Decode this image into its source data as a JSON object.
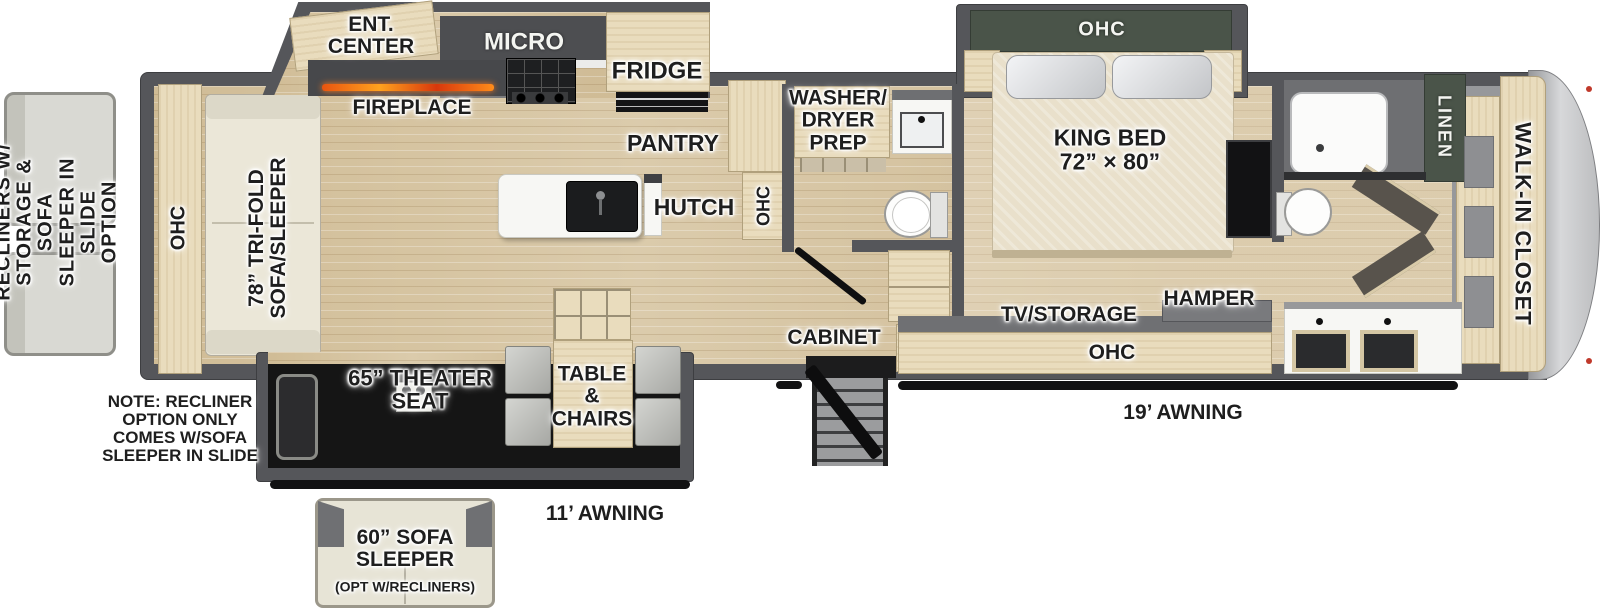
{
  "colors": {
    "wall": "#55565a",
    "floor_wood": "#d6c4a0",
    "cabinet_wood": "#e9dcbd",
    "accent_green": "#4a5449",
    "cap_gray": "#c9cacc",
    "label_black": "#1e1e1e",
    "label_white": "#f4f5f1",
    "ember_orange": "#ff7a1e"
  },
  "options_left": {
    "label": "RECLINERS W/\nSTORAGE & SOFA\nSLEEPER IN SLIDE\nOPTION"
  },
  "note": {
    "text": "NOTE: RECLINER\nOPTION ONLY\nCOMES W/SOFA\nSLEEPER IN SLIDE"
  },
  "living_area": {
    "ohc_rear": "OHC",
    "sofa": "78” TRI-FOLD\nSOFA/SLEEPER",
    "ent_center": "ENT.\nCENTER",
    "fireplace": "FIREPLACE",
    "micro": "MICRO",
    "fridge": "FRIDGE",
    "pantry": "PANTRY",
    "hutch": "HUTCH",
    "ohc_kitchen": "OHC",
    "theater_seat": "65” THEATER\nSEAT",
    "table_chairs": "TABLE\n&\nCHAIRS"
  },
  "mid_bath": {
    "washer_dryer_prep": "WASHER/\nDRYER\nPREP"
  },
  "bedroom": {
    "ohc_overhead": "OHC",
    "king_bed": "KING BED\n72” × 80”",
    "tv_storage": "TV/STORAGE",
    "hamper": "HAMPER",
    "ohc_bottom": "OHC",
    "cabinet": "CABINET"
  },
  "rear_bath": {
    "linen": "LINEN"
  },
  "front_closet": {
    "walk_in": "WALK-IN CLOSET"
  },
  "exterior": {
    "awning_door_side": "19’ AWNING",
    "awning_off_door": "11’ AWNING",
    "sofa_option_main": "60” SOFA\nSLEEPER",
    "sofa_option_sub": "(OPT W/RECLINERS)"
  }
}
